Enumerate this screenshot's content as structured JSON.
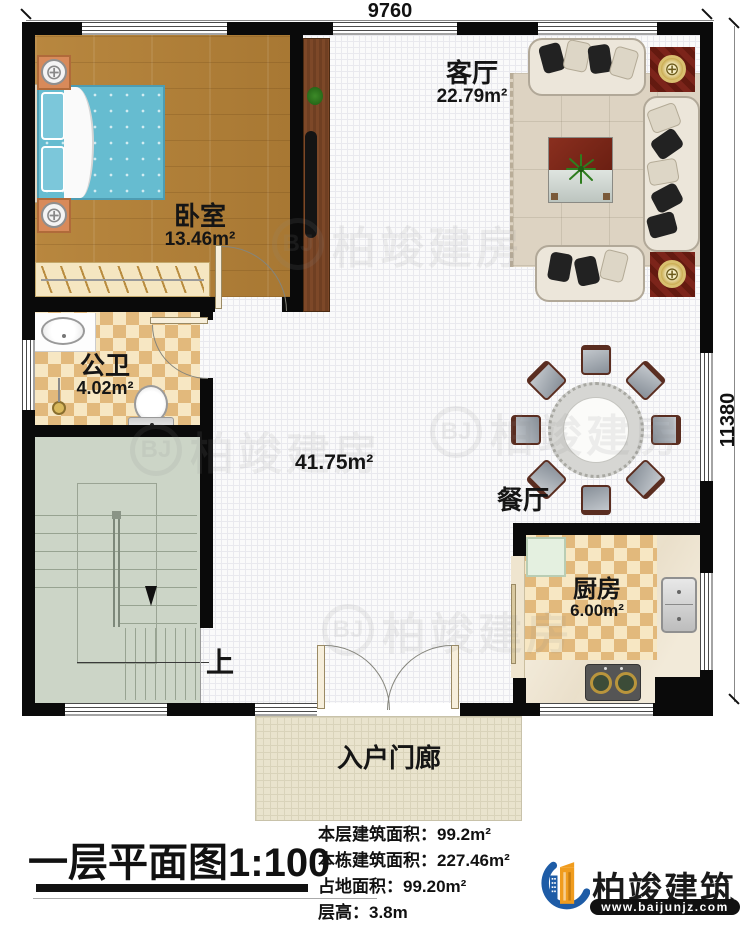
{
  "dimensions": {
    "top": "9760",
    "right": "11380"
  },
  "rooms": {
    "bedroom": {
      "name": "卧室",
      "area": "13.46m²"
    },
    "living_room": {
      "name": "客厅",
      "area": "22.79m²"
    },
    "bathroom": {
      "name": "公卫",
      "area": "4.02m²"
    },
    "hall": {
      "area": "41.75m²"
    },
    "dining_room": {
      "name": "餐厅"
    },
    "kitchen": {
      "name": "厨房",
      "area": "6.00m²"
    },
    "porch": {
      "name": "入户门廊"
    },
    "stairs": {
      "direction_label": "上"
    }
  },
  "footer": {
    "plan_title": "一层平面图",
    "plan_scale": "1:100",
    "stats": [
      {
        "label": "本层建筑面积：",
        "value": "99.2m²"
      },
      {
        "label": "本栋建筑面积：",
        "value": "227.46m²"
      },
      {
        "label": "占地面积：",
        "value": "99.20m²"
      },
      {
        "label": "层高：",
        "value": "3.8m"
      }
    ],
    "logo": {
      "company": "柏竣建筑",
      "website": "www.baijunjz.com"
    }
  },
  "watermark": {
    "text": "柏竣建房",
    "badge": "BJ"
  },
  "colors": {
    "wall": "#0a0a0a",
    "wood_floor": "#b2813a",
    "tile_accent": "#e2b97c",
    "stair_floor": "#ccd5c7",
    "porch_floor": "#e9e3cd",
    "logo_blue": "#1e5ca6",
    "logo_orange": "#f09c1e"
  }
}
